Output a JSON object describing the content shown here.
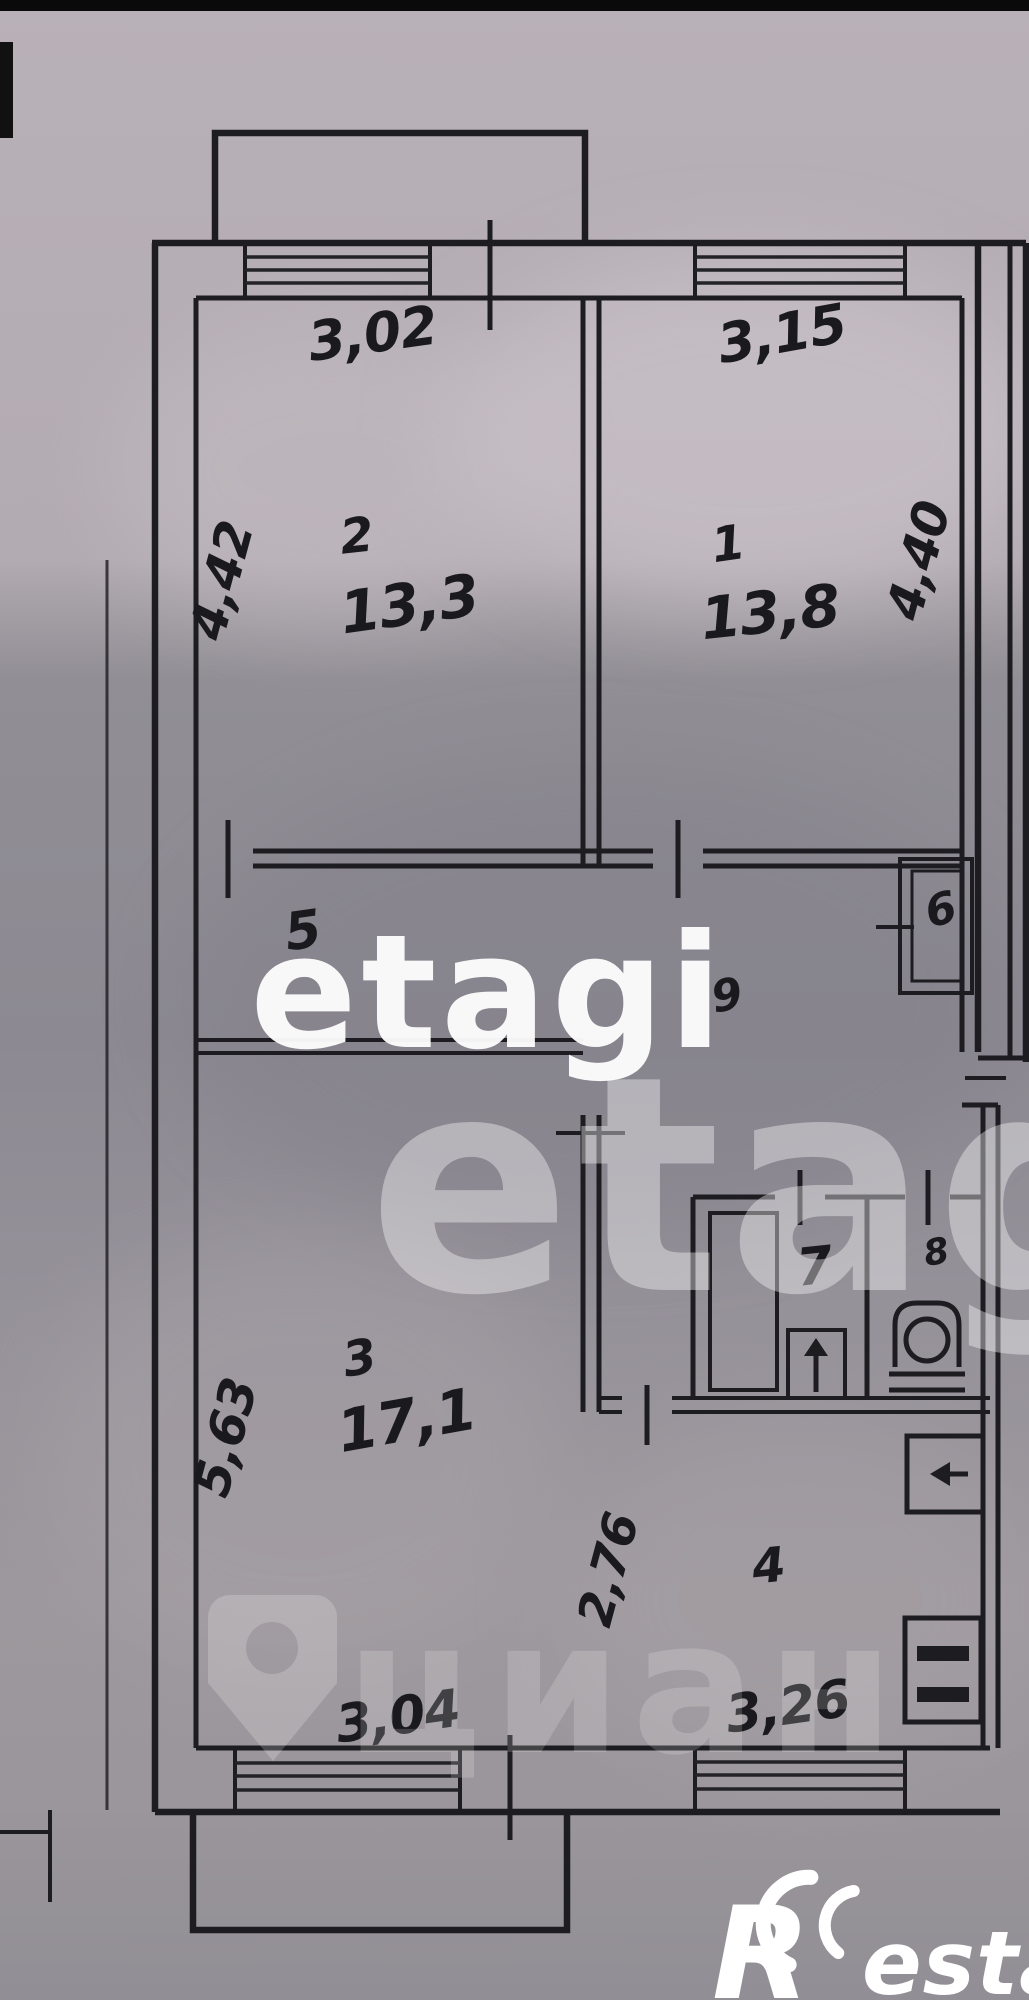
{
  "plan": {
    "room_numbers": {
      "r1": "1",
      "r2": "2",
      "r3": "3",
      "r4": "4",
      "r5": "5",
      "r6": "6",
      "r7": "7",
      "r8": "8",
      "r9": "9"
    },
    "areas": {
      "r1": "13,8",
      "r2": "13,3",
      "r3": "17,1"
    },
    "dims": {
      "top_left": "3,02",
      "top_right": "3,15",
      "side_left_upper": "4,42",
      "side_right_upper": "4,40",
      "side_left_lower": "5,63",
      "kitchen_depth": "2,76",
      "bottom_left": "3,04",
      "bottom_right": "3,26"
    }
  },
  "watermarks": {
    "etagi_primary": "etagi",
    "etagi_secondary": "etag",
    "cian_text": "циан",
    "restate_r": "R",
    "restate_rest": "estate"
  }
}
